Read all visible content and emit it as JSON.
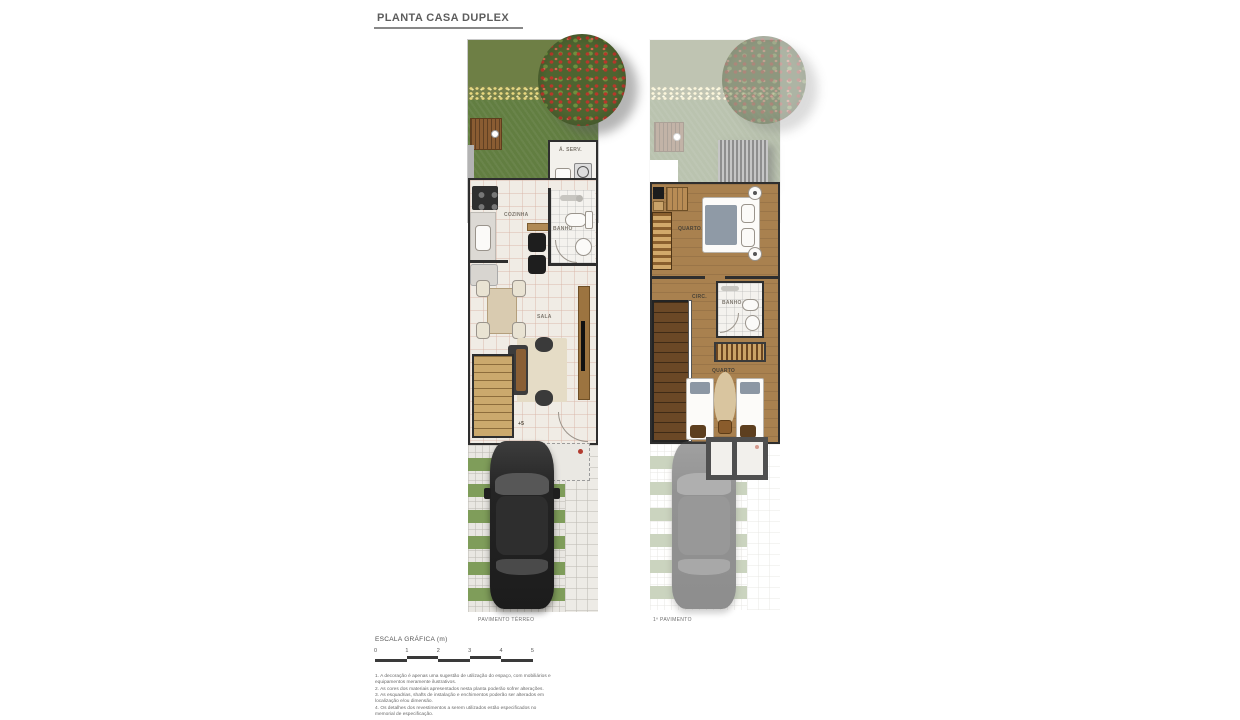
{
  "title": "PLANTA CASA DUPLEX",
  "ground": {
    "caption": "PAVIMENTO TÉRREO",
    "service_label": "Á. SERV.",
    "kitchen_label": "COZINHA",
    "bath_label": "BANHO",
    "living_label": "SALA",
    "level_marker": "+5"
  },
  "upper": {
    "caption": "1º PAVIMENTO",
    "bedroom1_label": "QUARTO",
    "circulation_label": "CIRC.",
    "bath_label": "BANHO",
    "bedroom2_label": "QUARTO"
  },
  "scale": {
    "label": "ESCALA GRÁFICA (m)",
    "ticks": [
      "0",
      "1",
      "2",
      "3",
      "4",
      "5"
    ]
  },
  "notes": [
    "1. A decoração é apenas uma sugestão de utilização do espaço, com mobiliários e equipamentos meramente ilustrativos.",
    "2. As cores dos materiais apresentados nesta planta poderão sofrer alterações.",
    "3. As esquadrias, shafts de instalação e enchimentos poderão ser alterados em localização e/ou dimensão.",
    "4. Os detalhes dos revestimentos a serem utilizados estão especificados no memorial de especificação."
  ],
  "colors": {
    "grass_dark": "#6e7f45",
    "grass_yard": "#627e41",
    "grass_strip": "#7f9d5a",
    "wood_floor": "#a9814f",
    "wall": "#2e2e2e",
    "accent_red": "#b23b2f"
  }
}
